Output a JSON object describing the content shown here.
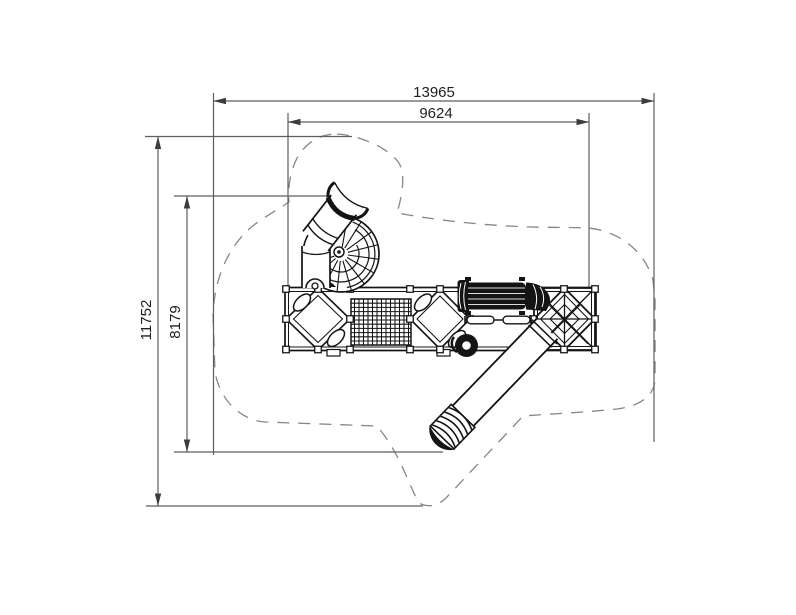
{
  "canvas": {
    "background": "#ffffff"
  },
  "dimensions": {
    "top_outer": "13965",
    "top_inner": "9624",
    "left_outer": "11752",
    "left_inner": "8179"
  },
  "style": {
    "artwork_color": "#141414",
    "dimension_line_color": "#5e5e5e",
    "boundary_dash_color": "#868686",
    "text_color": "#1f1f1f"
  }
}
